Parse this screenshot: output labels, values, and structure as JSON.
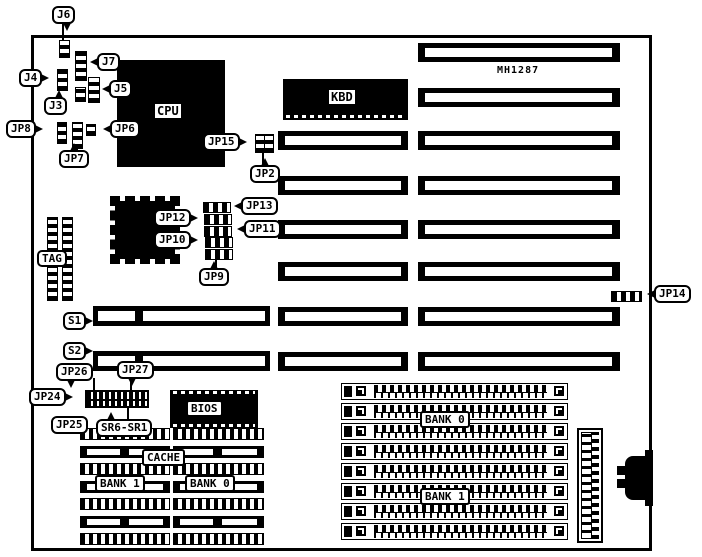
{
  "board": {
    "model": "MH1287"
  },
  "chips": {
    "cpu": "CPU",
    "kbd": "KBD",
    "bios": "BIOS",
    "tag": "TAG",
    "cache": "CACHE",
    "sr6sr1": "SR6-SR1"
  },
  "banks": {
    "cache_bank1": "BANK 1",
    "cache_bank0": "BANK 0",
    "simm_bank0": "BANK 0",
    "simm_bank1": "BANK 1"
  },
  "callouts": {
    "j6": "J6",
    "j7": "J7",
    "j5": "J5",
    "j4": "J4",
    "j3": "J3",
    "jp8": "JP8",
    "jp7": "JP7",
    "jp6": "JP6",
    "jp15": "JP15",
    "jp2": "JP2",
    "jp13": "JP13",
    "jp12": "JP12",
    "jp11": "JP11",
    "jp10": "JP10",
    "jp9": "JP9",
    "jp14": "JP14",
    "s1": "S1",
    "s2": "S2",
    "jp26": "JP26",
    "jp27": "JP27",
    "jp24": "JP24",
    "jp25": "JP25"
  }
}
